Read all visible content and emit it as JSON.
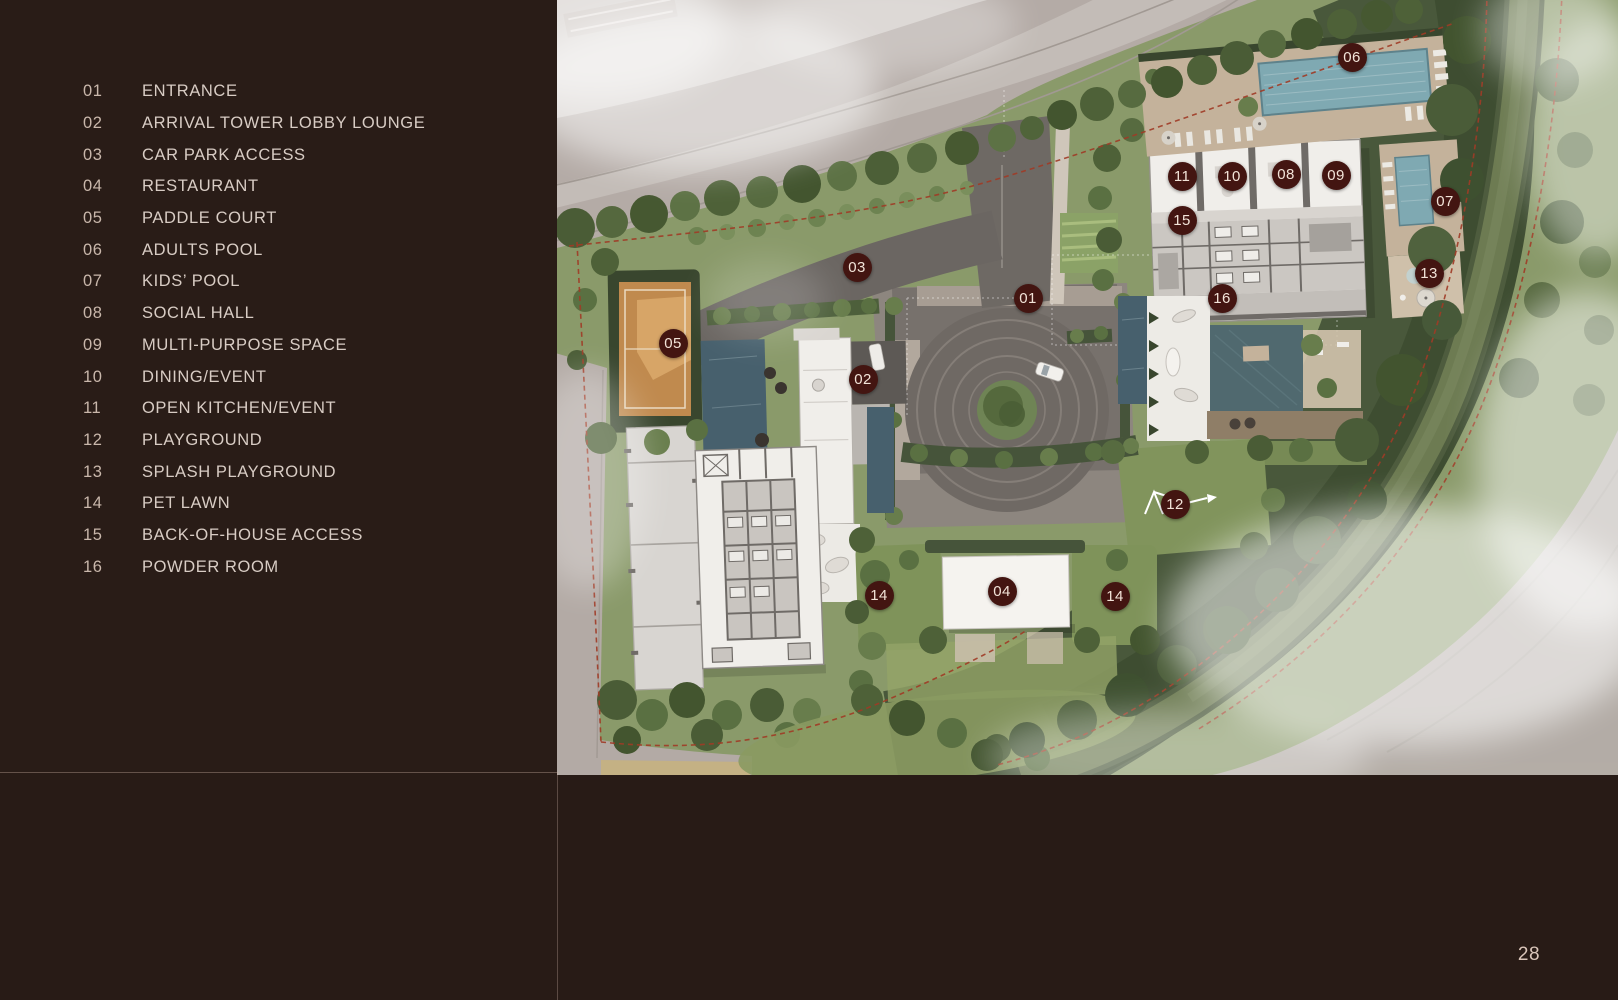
{
  "sidebar": {
    "legend": [
      {
        "num": "01",
        "label": "ENTRANCE"
      },
      {
        "num": "02",
        "label": "ARRIVAL TOWER LOBBY LOUNGE"
      },
      {
        "num": "03",
        "label": "CAR PARK ACCESS"
      },
      {
        "num": "04",
        "label": "RESTAURANT"
      },
      {
        "num": "05",
        "label": "PADDLE COURT"
      },
      {
        "num": "06",
        "label": "ADULTS POOL"
      },
      {
        "num": "07",
        "label": "KIDS’ POOL"
      },
      {
        "num": "08",
        "label": "SOCIAL HALL"
      },
      {
        "num": "09",
        "label": "MULTI-PURPOSE SPACE"
      },
      {
        "num": "10",
        "label": "DINING/EVENT"
      },
      {
        "num": "11",
        "label": "OPEN KITCHEN/EVENT"
      },
      {
        "num": "12",
        "label": "PLAYGROUND"
      },
      {
        "num": "13",
        "label": "SPLASH PLAYGROUND"
      },
      {
        "num": "14",
        "label": "PET LAWN"
      },
      {
        "num": "15",
        "label": "BACK-OF-HOUSE ACCESS"
      },
      {
        "num": "16",
        "label": "POWDER ROOM"
      }
    ]
  },
  "map": {
    "markers": [
      {
        "label": "06",
        "x": 795,
        "y": 57
      },
      {
        "label": "11",
        "x": 625,
        "y": 176
      },
      {
        "label": "10",
        "x": 675,
        "y": 176
      },
      {
        "label": "08",
        "x": 729,
        "y": 174
      },
      {
        "label": "09",
        "x": 779,
        "y": 175
      },
      {
        "label": "07",
        "x": 888,
        "y": 201
      },
      {
        "label": "15",
        "x": 625,
        "y": 220
      },
      {
        "label": "13",
        "x": 872,
        "y": 273
      },
      {
        "label": "03",
        "x": 300,
        "y": 267
      },
      {
        "label": "01",
        "x": 471,
        "y": 298
      },
      {
        "label": "16",
        "x": 665,
        "y": 298
      },
      {
        "label": "05",
        "x": 116,
        "y": 343
      },
      {
        "label": "02",
        "x": 306,
        "y": 379
      },
      {
        "label": "12",
        "x": 618,
        "y": 504
      },
      {
        "label": "14",
        "x": 322,
        "y": 595
      },
      {
        "label": "04",
        "x": 445,
        "y": 591
      },
      {
        "label": "14",
        "x": 558,
        "y": 596
      }
    ],
    "colors": {
      "marker_bg": "#431511",
      "marker_text": "#f2e3d8",
      "boundary_line": "#a03b26",
      "pool": "#7fa9b2",
      "court": "#c08a4e",
      "canal": "#6d7b52"
    }
  },
  "footer": {
    "page_number": "28"
  }
}
